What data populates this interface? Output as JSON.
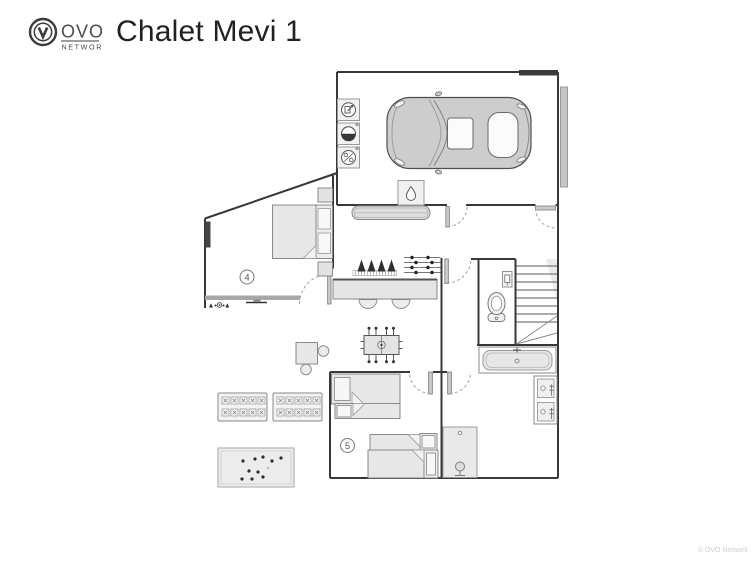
{
  "header": {
    "logo": {
      "text": "OVO",
      "subtext": "NETWORK"
    },
    "title": "Chalet Mevi 1"
  },
  "floorplan": {
    "rooms": [
      {
        "name": "bedroom-4",
        "number": "4"
      },
      {
        "name": "bedroom-5",
        "number": "5"
      }
    ],
    "colors": {
      "wall": "#383838",
      "furniture_fill": "#e7e7e7",
      "furniture_stroke": "#8a8a8a",
      "car_fill": "#cdcdcd",
      "window_glazing": "#a8a8a8",
      "dark_icon": "#2f2f2f"
    },
    "icons": [
      "boot-room-appliance",
      "washing-machine",
      "tumble-dryer",
      "water-heater-drop",
      "car",
      "garage-door",
      "bench",
      "boot-warmer",
      "ski-rack",
      "counter-chairs",
      "double-bed",
      "bunk-beds",
      "foosball-table",
      "games-table",
      "locker-unit",
      "rug",
      "toilet",
      "flush-plate",
      "stairs",
      "bathtub",
      "twin-sinks",
      "shower"
    ]
  },
  "footer": {
    "copyright": "© OVO Network"
  }
}
